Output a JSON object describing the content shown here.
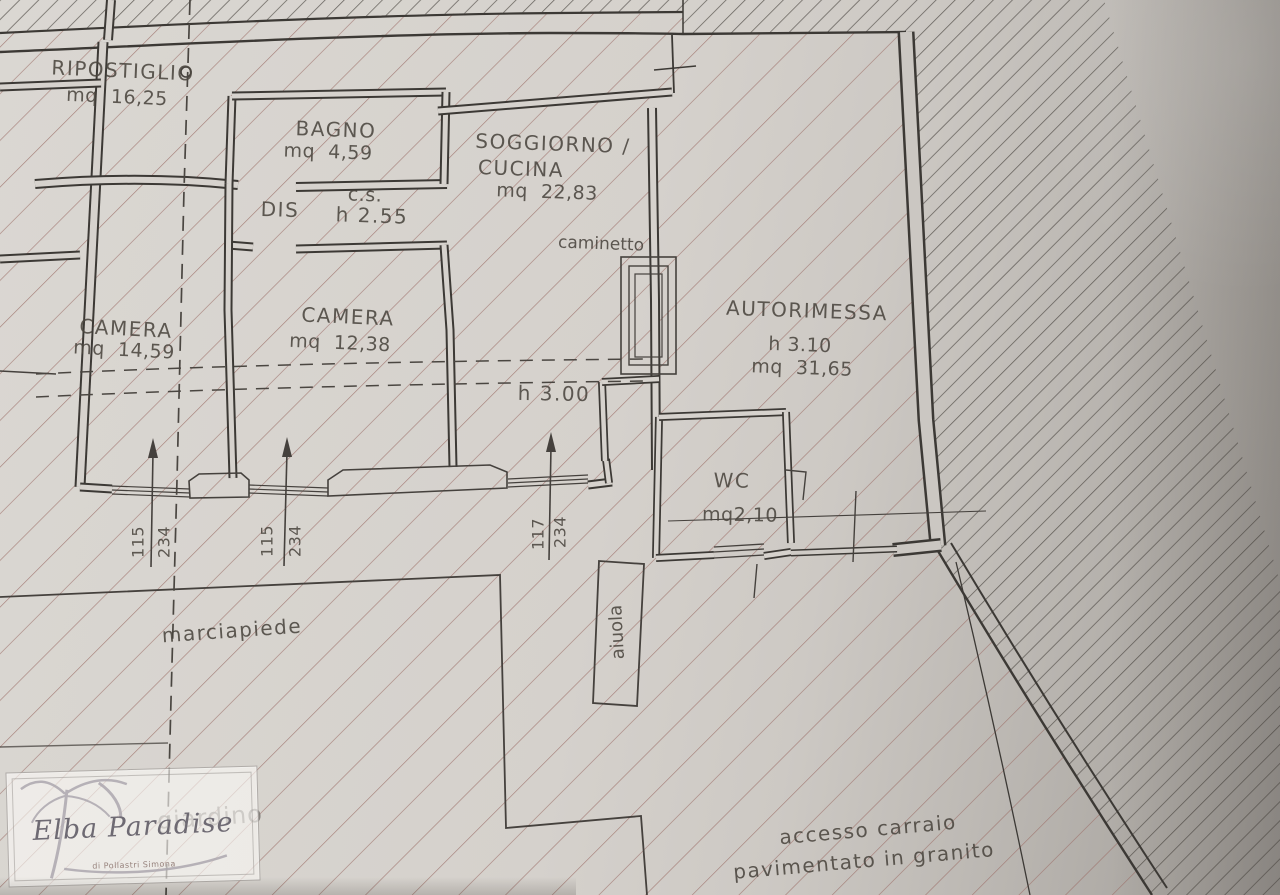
{
  "document_type": "floor-plan-photo",
  "colors": {
    "paper": "#d6d2cd",
    "paper_shadow": "#a29e9a",
    "hatch_property": "#9c7068",
    "hatch_outside": "#534e49",
    "wall": "#3c3935",
    "label_text": "#4b463f",
    "faded_text": "#7b7772",
    "watermark_text": "#6e6a73"
  },
  "rooms": {
    "ripostiglio": {
      "name": "RIPOSTIGLIO",
      "area": "mq  16,25"
    },
    "bagno": {
      "name": "BAGNO",
      "area": "mq  4,59"
    },
    "soggiorno": {
      "name_line1": "SOGGIORNO /",
      "name_line2": "CUCINA",
      "area": "mq  22,83"
    },
    "dis": {
      "name": "DIS"
    },
    "cs": {
      "name": "c.s.",
      "height": "h 2.55"
    },
    "camera1": {
      "name": "CAMERA",
      "area": "mq  14,59"
    },
    "camera2": {
      "name": "CAMERA",
      "area": "mq  12,38"
    },
    "autorimessa": {
      "name": "AUTORIMESSA",
      "height": "h 3.10",
      "area": "mq  31,65"
    },
    "wc": {
      "name": "WC",
      "area": "mq2,10"
    }
  },
  "annotations": {
    "caminetto": "caminetto",
    "height_main": "h 3.00",
    "marciapiede": "marciapiede",
    "aiuola": "aiuola",
    "giardino": "giardino",
    "accesso_line1": "accesso carraio",
    "accesso_line2": "pavimentato in granito"
  },
  "windows": [
    {
      "width": "115",
      "height": "234"
    },
    {
      "width": "115",
      "height": "234"
    },
    {
      "width": "117",
      "height": "234"
    }
  ],
  "watermark": {
    "brand": "Elba Paradise",
    "subtitle": "di Pollastri Simona"
  }
}
